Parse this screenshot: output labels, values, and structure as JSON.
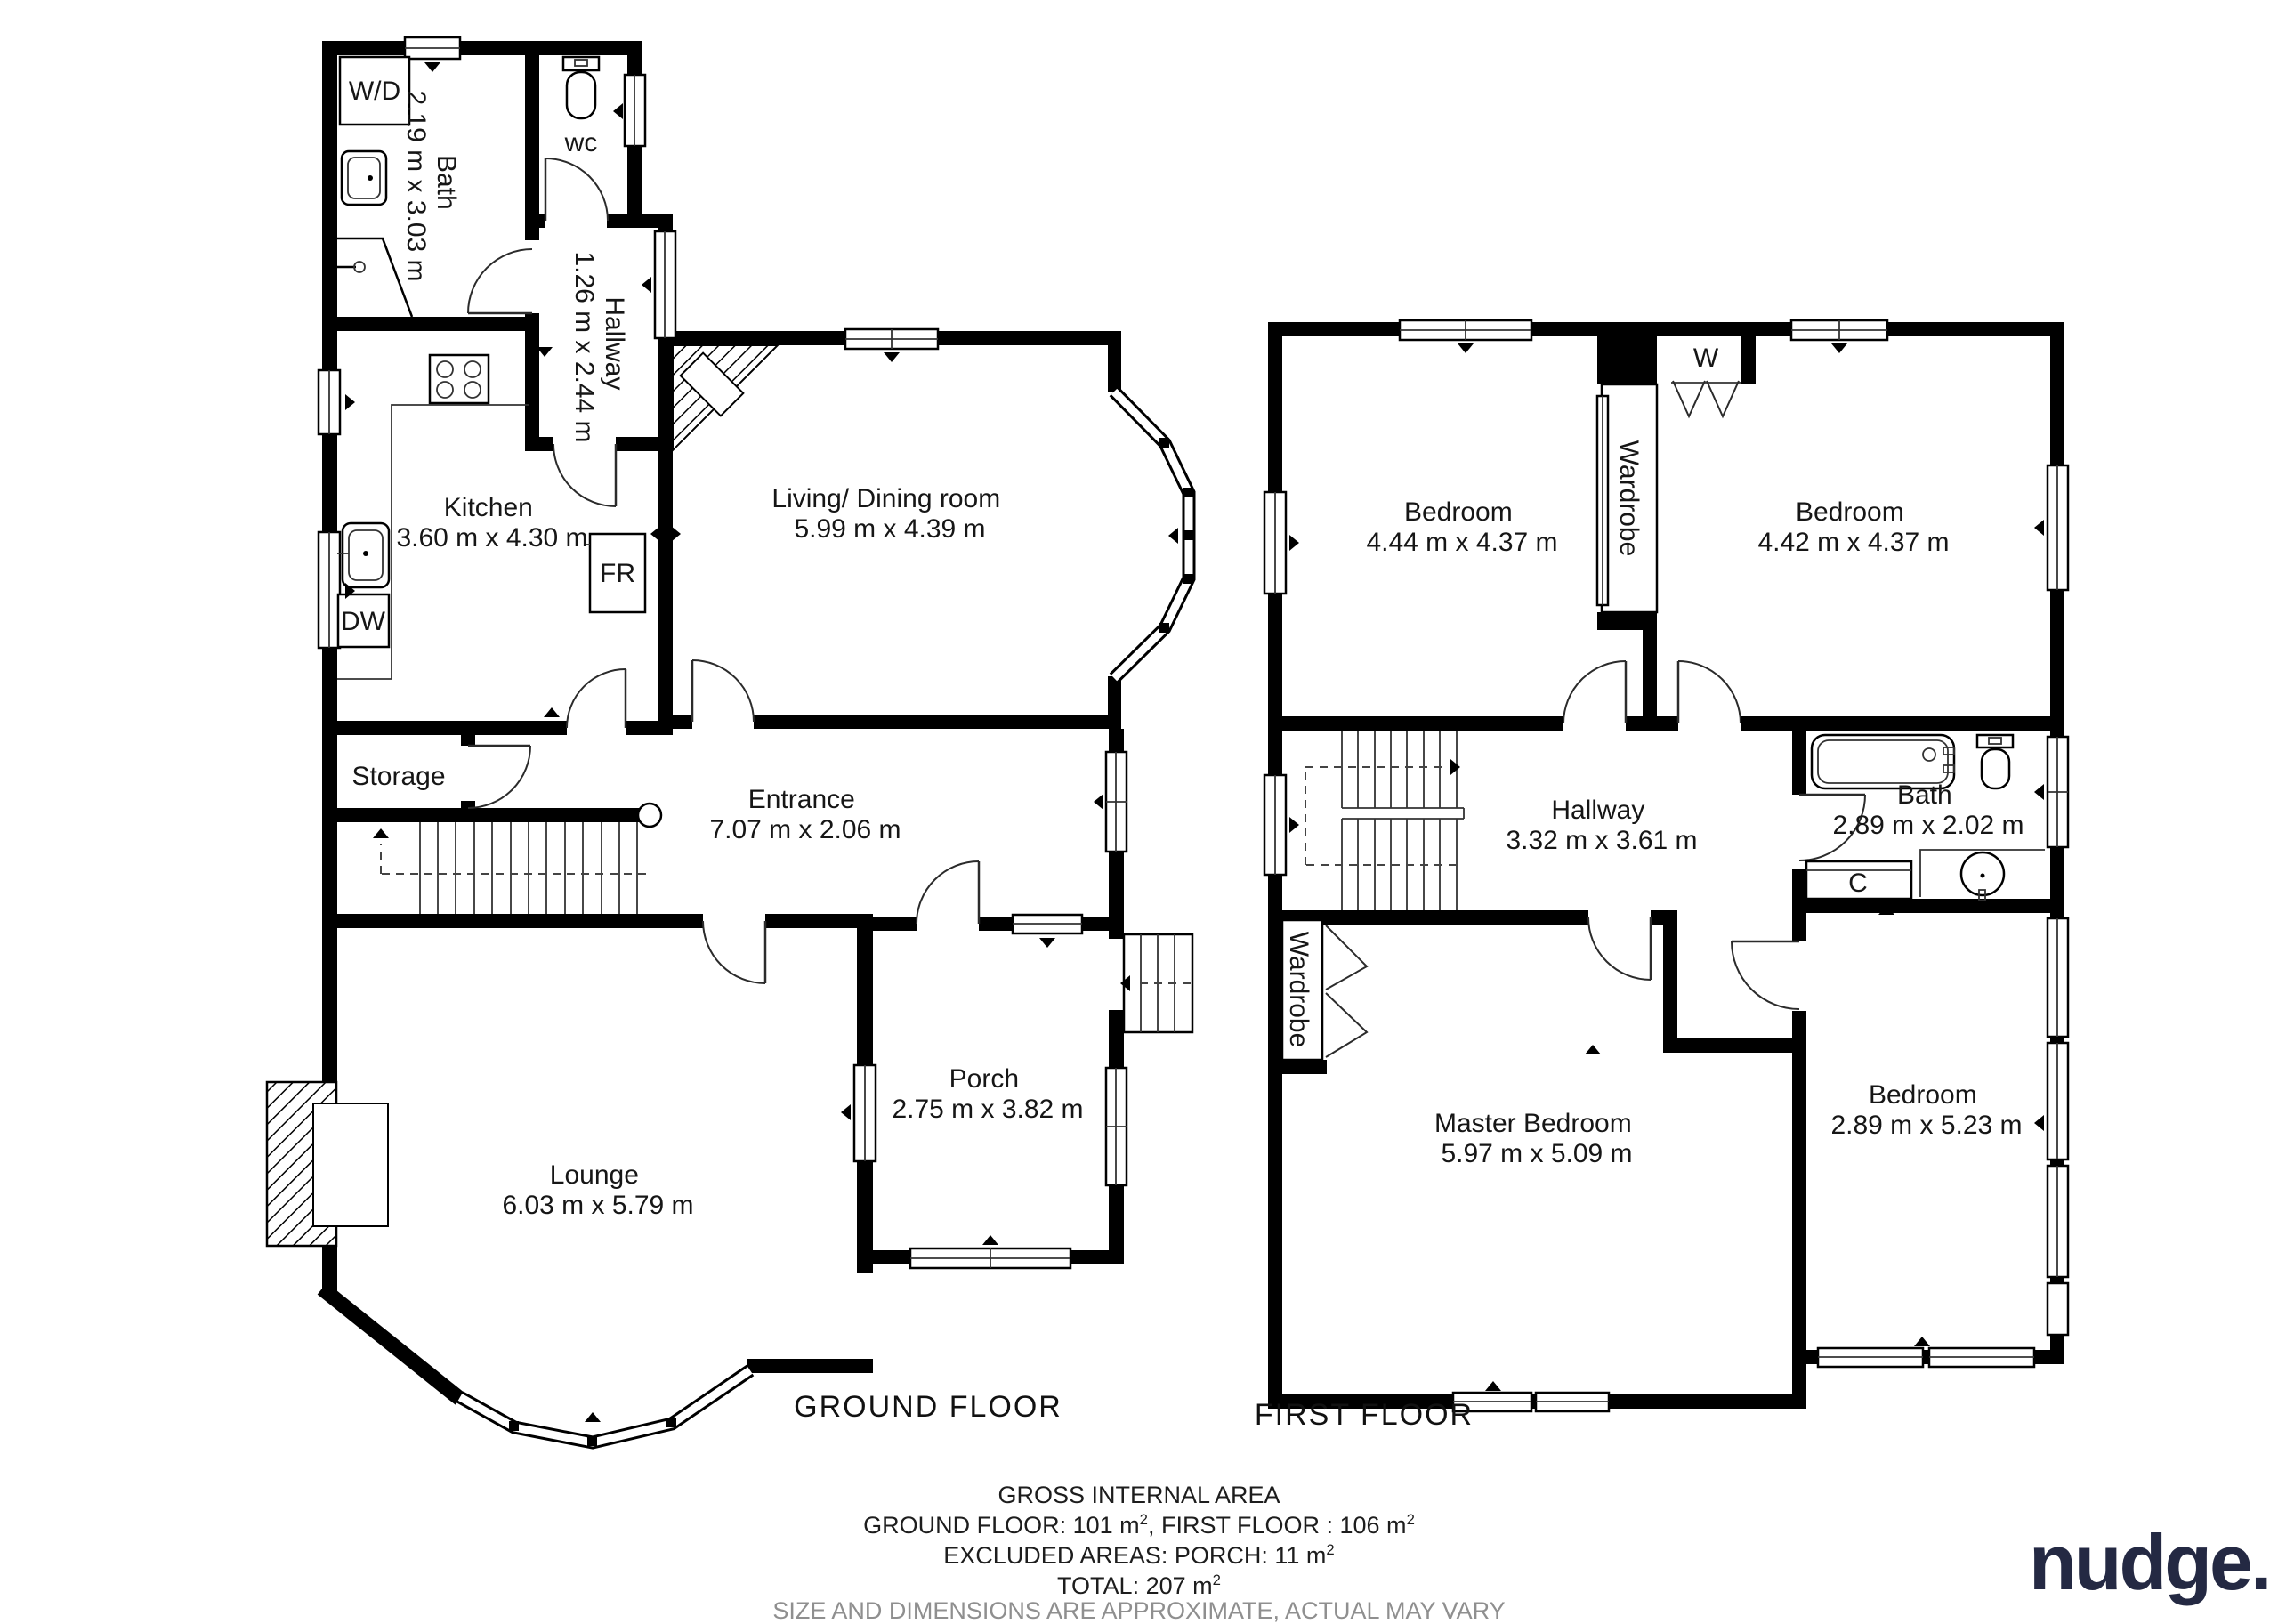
{
  "ground": {
    "title": "GROUND FLOOR",
    "bath": {
      "name": "Bath",
      "dims": "2.19 m x 3.03 m"
    },
    "wc": {
      "name": "wc"
    },
    "hallway": {
      "name": "Hallway",
      "dims": "1.26 m x 2.44 m"
    },
    "kitchen": {
      "name": "Kitchen",
      "dims": "3.60 m x 4.30 m"
    },
    "living": {
      "name": "Living/ Dining room",
      "dims": "5.99 m x 4.39 m"
    },
    "storage": {
      "name": "Storage"
    },
    "entrance": {
      "name": "Entrance",
      "dims": "7.07 m x 2.06 m"
    },
    "lounge": {
      "name": "Lounge",
      "dims": "6.03 m x 5.79 m"
    },
    "porch": {
      "name": "Porch",
      "dims": "2.75 m x 3.82 m"
    },
    "appliances": {
      "washer_dryer": "W/D",
      "dishwasher": "DW",
      "fridge": "FR"
    }
  },
  "first": {
    "title": "FIRST FLOOR",
    "bedroom1": {
      "name": "Bedroom",
      "dims": "4.44 m x 4.37 m"
    },
    "bedroom2": {
      "name": "Bedroom",
      "dims": "4.42 m x 4.37 m"
    },
    "hallway": {
      "name": "Hallway",
      "dims": "3.32 m x 3.61 m"
    },
    "bath": {
      "name": "Bath",
      "dims": "2.89 m x 2.02 m"
    },
    "master": {
      "name": "Master Bedroom",
      "dims": "5.97 m x 5.09 m"
    },
    "bedroom3": {
      "name": "Bedroom",
      "dims": "2.89 m x 5.23 m"
    },
    "wardrobe_top": "Wardrobe",
    "wardrobe_master": "Wardrobe",
    "closet_w": "W",
    "cupboard_c": "C"
  },
  "footer": {
    "title": "GROSS INTERNAL AREA",
    "areas_a": "GROUND FLOOR: 101 m",
    "areas_a_sup": "2",
    "areas_b": ", FIRST FLOOR : 106 m",
    "areas_b_sup": "2",
    "excluded": "EXCLUDED AREAS: PORCH: 11 m",
    "excluded_sup": "2",
    "total": "TOTAL: 207 m",
    "total_sup": "2",
    "disclaimer": "SIZE AND DIMENSIONS ARE APPROXIMATE, ACTUAL MAY VARY"
  },
  "branding": {
    "logo_text": "nudge.",
    "logo_color": "#242943"
  }
}
